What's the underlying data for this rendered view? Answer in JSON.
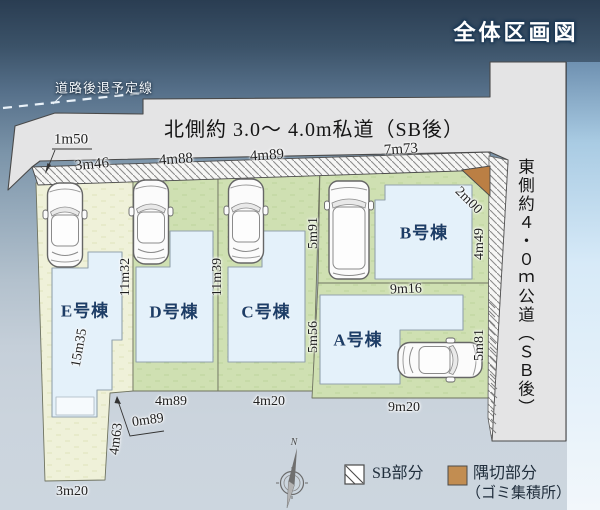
{
  "title": "全体区画図",
  "setback_line": {
    "label": "道路後退予定線"
  },
  "roads": {
    "north": "北側約 3.0〜 4.0m私道（SB後）",
    "east": "東側約４・０ｍ公道（ＳＢ後）"
  },
  "lots": {
    "a": "A号棟",
    "b": "B号棟",
    "c": "C号棟",
    "d": "D号棟",
    "e": "E号棟"
  },
  "dims": {
    "d1m50": "1m50",
    "d3m46": "3m46",
    "d4m88": "4m88",
    "d4m89_top": "4m89",
    "d7m73": "7m73",
    "d2m00": "2m00",
    "d4m49": "4m49",
    "d5m91": "5m91",
    "d9m16": "9m16",
    "d5m56": "5m56",
    "d5m81": "5m81",
    "d11m32": "11m32",
    "d11m39": "11m39",
    "d15m35": "15m35",
    "d4m63": "4m63",
    "d0m89": "0m89",
    "d4m89_bottom": "4m89",
    "d4m20": "4m20",
    "d9m20": "9m20",
    "d3m20": "3m20"
  },
  "legend": {
    "sb_label": "SB部分",
    "corner_label": "隅切部分",
    "corner_note": "（ゴミ集積所）"
  },
  "compass": {
    "north_label": "N"
  },
  "colors": {
    "lot_green": "#cfe0b2",
    "lot_e_green": "#eff1d9",
    "building_blue": "#e4f1fa",
    "road_gray": "#e4e4e5",
    "corner_orange": "#bb7f44",
    "legend_orange": "#c28d51",
    "label_navy": "#1d3d66",
    "sky_dark": "#2a3d52"
  }
}
